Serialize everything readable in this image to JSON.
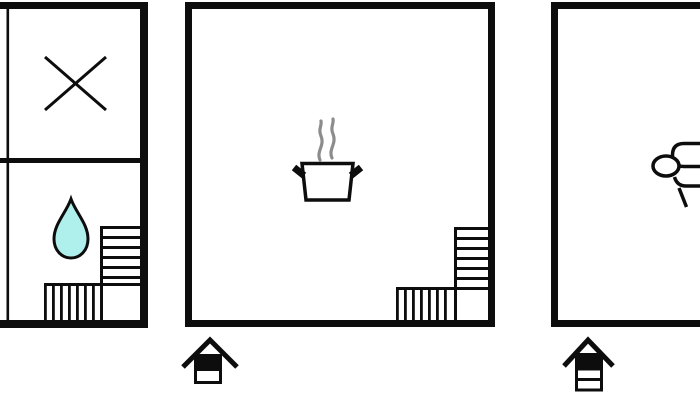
{
  "image": {
    "kind": "floor-plan-diagram",
    "title": "three-section holiday home floor plan",
    "sections": [
      {
        "name": "left-floor-section",
        "partially_visible_left_edge": true,
        "rooms_count": 2,
        "icons": [
          "crossed-lines-icon",
          "water-drop-icon",
          "stairs-icon"
        ],
        "level_indicator": null
      },
      {
        "name": "middle-floor-section",
        "rooms_count": 1,
        "icons": [
          "cooking-pot-icon",
          "steam-icon",
          "stairs-icon"
        ],
        "level_indicator": {
          "levels": 2,
          "highlighted_level": "top"
        }
      },
      {
        "name": "right-floor-section",
        "partially_visible_right_edge": true,
        "rooms_count": 1,
        "icons": [
          "bed-icon"
        ],
        "level_indicator": {
          "levels": 3,
          "highlighted_level": "top"
        }
      }
    ]
  },
  "colors": {
    "line": "#0d0d0d",
    "background": "#ffffff",
    "water_drop_fill": "#b0f0ec",
    "steam": "#8c8c8c"
  }
}
